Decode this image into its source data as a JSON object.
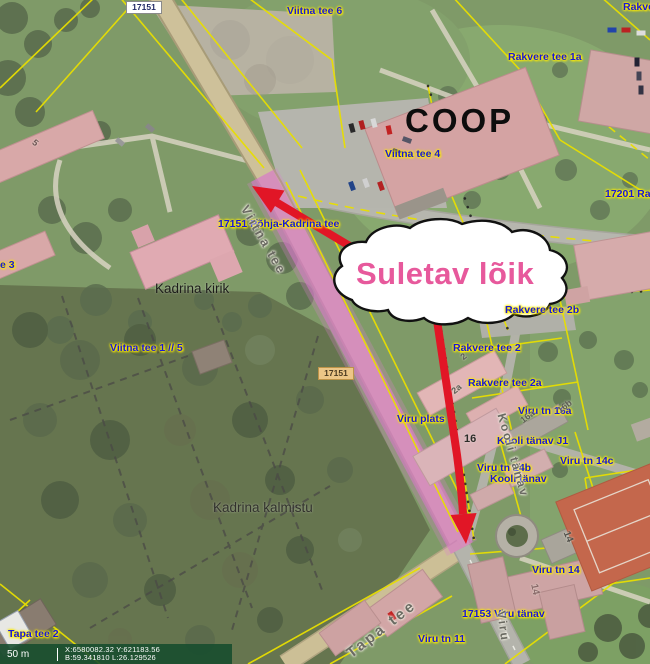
{
  "annotation": {
    "closure_text": "Suletav lõik",
    "closure_text_color": "#e7599c",
    "arrow_color": "#e11626",
    "road_highlight_color": "#d885cc"
  },
  "road_numbers": {
    "top": "17151",
    "mid": "17151"
  },
  "labels": {
    "viitna_tee_6": "Viitna tee 6",
    "rakvere_corner": "Rakve",
    "rakvere_tee_1a": "Rakvere tee 1a",
    "coop": "COOP",
    "viitna_tee_4": "Viitna tee 4",
    "r17201": "17201 Rakv",
    "pohja_kadrina": "17151 Põhja-Kadrina tee",
    "e3": "e 3",
    "kadrina_kirik": "Kadrina kirik",
    "viitna_tee_1_5": "Viitna tee 1 // 5",
    "rakvere_tee_2b": "Rakvere tee 2b",
    "rakvere_tee_2": "Rakvere tee 2",
    "rakvere_tee_2a": "Rakvere tee 2a",
    "viru_tn_16a": "Viru tn 16a",
    "viru_plats": "Viru plats",
    "kooli_tanav_j1": "Kooli tänav J1",
    "bldg_16": "16",
    "viru_tn_14b": "Viru tn 14b",
    "viru_tn_14c": "Viru tn 14c",
    "kooli_tanav": "Kooli tänav",
    "kadrina_kalmistu": "Kadrina kalmistu",
    "viru_tn_14": "Viru tn 14",
    "v17153": "17153 Viru tänav",
    "viru_tn_11": "Viru tn 11",
    "tapa_tee_2": "Tapa tee 2"
  },
  "street_names": {
    "viitna_tee": "Viitna tee",
    "kooli_tanav": "Kooli tänav",
    "tapa_tee": "Tapa tee",
    "viru": "Viru"
  },
  "parcel_numbers": {
    "p2": "2",
    "p2a": "2a",
    "p16a": "16a",
    "p16b": "16b",
    "roof_5": "5",
    "roof_14_gray": "14",
    "roof_14_pink": "14"
  },
  "statusbar": {
    "scale": "50 m",
    "coords_line1": "X:6580082.32 Y:621183.56",
    "coords_line2": "B:59.341810 L:26.129526"
  },
  "map_colors": {
    "cadastral_line": "#e8df00",
    "label_blue": "#1717d9",
    "grass": "#7f9a68"
  }
}
